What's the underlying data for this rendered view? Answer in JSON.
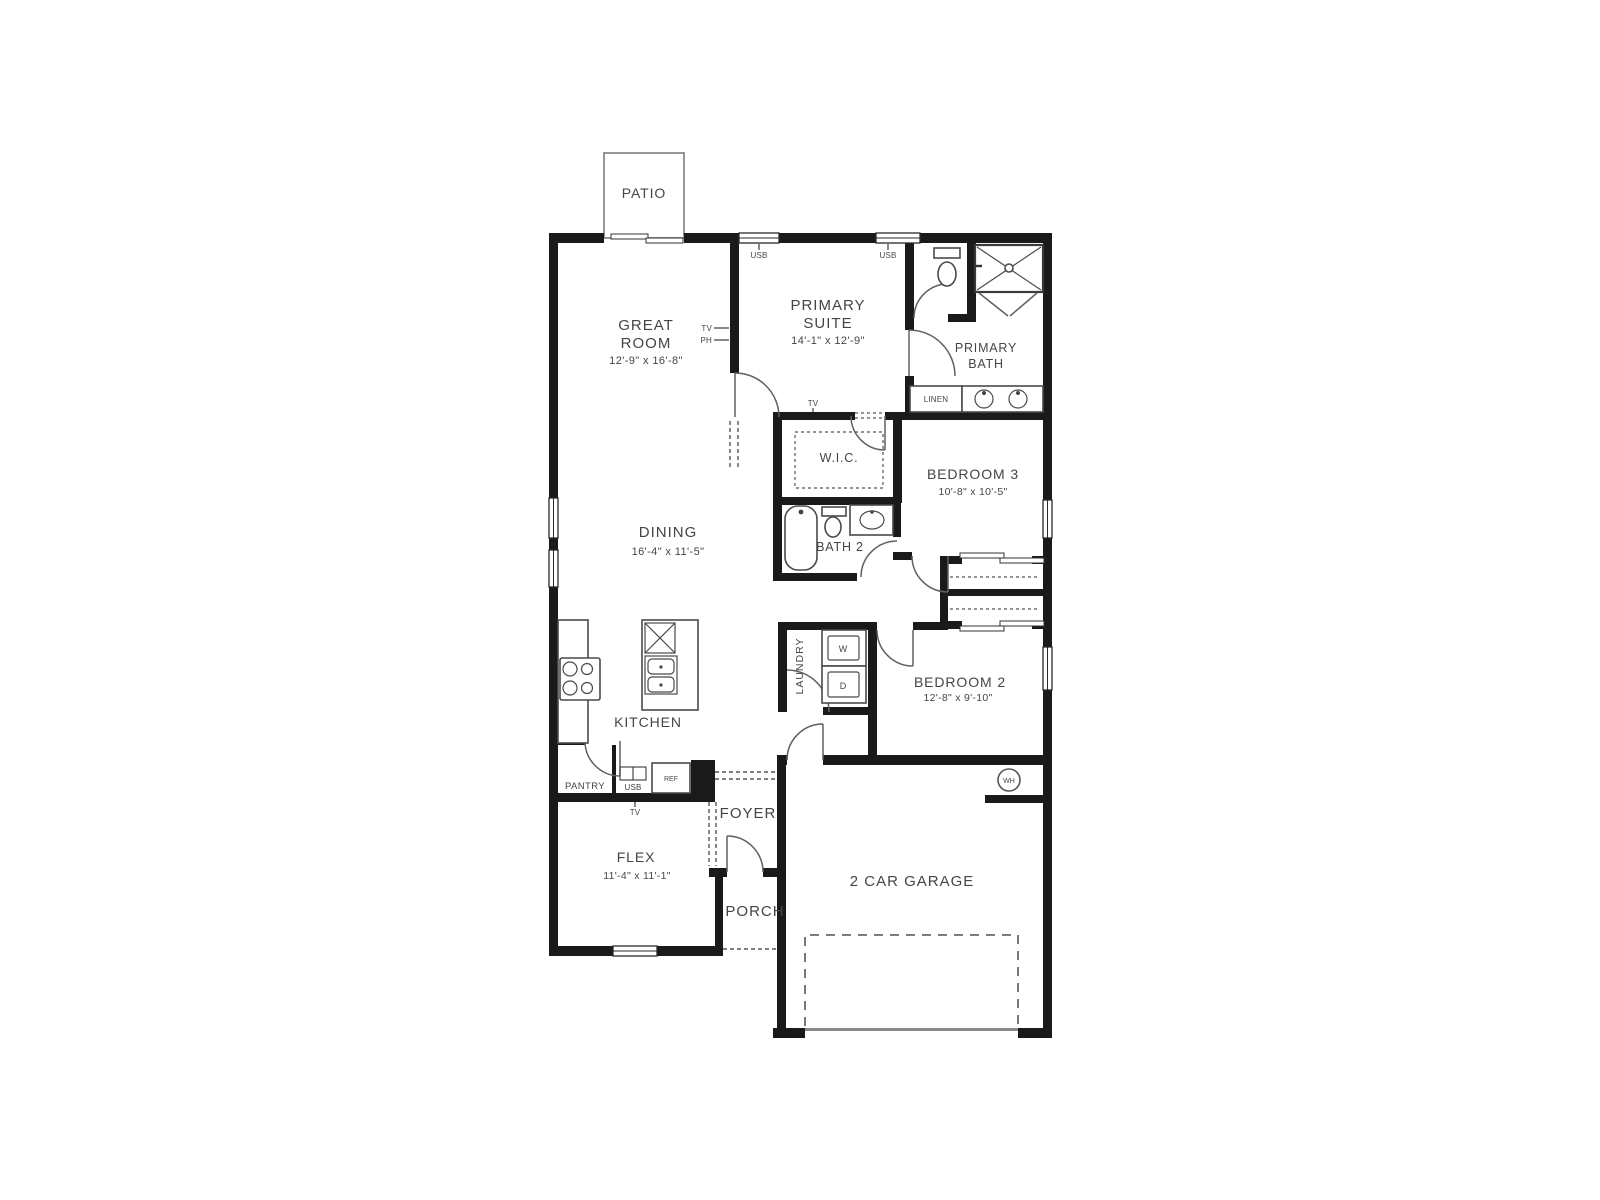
{
  "floorplan": {
    "rooms": {
      "patio": {
        "name": "PATIO"
      },
      "great_room": {
        "line1": "GREAT",
        "line2": "ROOM",
        "dims": "12'-9\" x 16'-8\""
      },
      "primary_suite": {
        "line1": "PRIMARY",
        "line2": "SUITE",
        "dims": "14'-1\" x 12'-9\""
      },
      "primary_bath": {
        "line1": "PRIMARY",
        "line2": "BATH"
      },
      "wic": {
        "name": "W.I.C."
      },
      "bedroom3": {
        "name": "BEDROOM 3",
        "dims": "10'-8\" x 10'-5\""
      },
      "dining": {
        "name": "DINING",
        "dims": "16'-4\" x 11'-5\""
      },
      "bath2": {
        "name": "BATH 2"
      },
      "bedroom2": {
        "name": "BEDROOM 2",
        "dims": "12'-8\" x 9'-10\""
      },
      "kitchen": {
        "name": "KITCHEN"
      },
      "laundry": {
        "name": "LAUNDRY"
      },
      "pantry": {
        "name": "PANTRY"
      },
      "flex": {
        "name": "FLEX",
        "dims": "11'-4\" x 11'-1\""
      },
      "foyer": {
        "name": "FOYER"
      },
      "porch": {
        "name": "PORCH"
      },
      "garage": {
        "name": "2 CAR GARAGE"
      },
      "linen": {
        "name": "LINEN"
      }
    },
    "fixtures": {
      "washer": "W",
      "dryer": "D",
      "water_heater": "WH",
      "refrigerator": "REF",
      "usb": "USB",
      "tv": "TV",
      "ph": "PH"
    },
    "colors": {
      "wall": "#1a1a1a",
      "text": "#454545",
      "background": "#ffffff"
    }
  }
}
